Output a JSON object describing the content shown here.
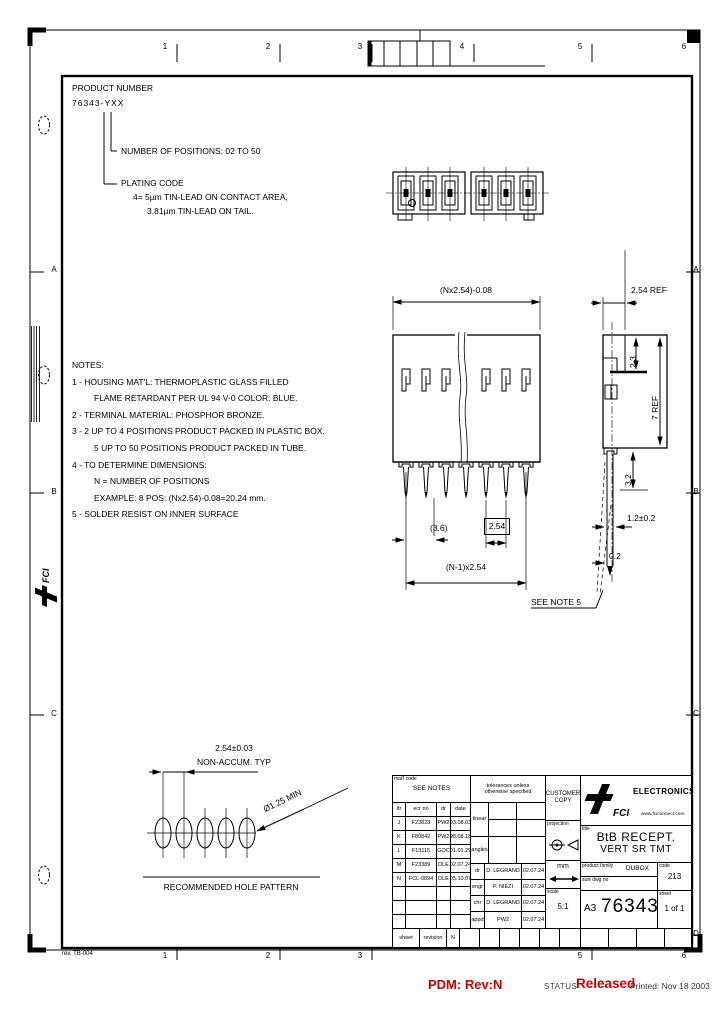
{
  "colors": {
    "line": "#000000",
    "paper": "#ffffff",
    "status_red": "#cc0000"
  },
  "icons": {
    "logo": "fci-lightning-f",
    "projection": "third-angle-projection",
    "units_arrow": "double-arrow"
  },
  "status_bar": {
    "pdm": "PDM: Rev:N",
    "status_label": "STATUS",
    "status_value": "Released",
    "printed": "Printed: Nov 18 2003"
  },
  "margins": {
    "rev_note": "rev. TB-004",
    "zone_numbers": [
      "1",
      "2",
      "3",
      "4",
      "5",
      "6"
    ],
    "zone_letters": [
      "A",
      "B",
      "C",
      "D"
    ]
  },
  "product": {
    "label": "PRODUCT NUMBER",
    "number": "76343-YXX",
    "positions": "NUMBER OF POSITIONS: 02 TO 50",
    "plating_title": "PLATING CODE",
    "plating1": "4= 5µm TIN-LEAD ON CONTACT AREA,",
    "plating2": "3.81µm TIN-LEAD ON TAIL."
  },
  "notes": {
    "lines": [
      "NOTES:",
      "1 - HOUSING MAT'L: THERMOPLASTIC GLASS FILLED",
      "FLAME RETARDANT PER UL 94 V-0 COLOR: BLUE.",
      "2 - TERMINAL MATERIAL: PHOSPHOR BRONZE.",
      "3 - 2 UP TO 4 POSITIONS PRODUCT PACKED IN PLASTIC BOX.",
      "5 UP TO 50 POSITIONS PRODUCT PACKED IN TUBE.",
      "4 - TO DETERMINE DIMENSIONS:",
      "N = NUMBER OF POSITIONS",
      "EXAMPLE: 8 POS: (Nx2.54)-0.08=20.24 mm.",
      "5 - SOLDER RESIST ON INNER SURFACE"
    ]
  },
  "dims": {
    "front_width": "(Nx2.54)-0.08",
    "pitch_ref": "2.54 REF",
    "pin_len": "(3.6)",
    "pitch_basic": "2.54",
    "span": "(N-1)x2.54",
    "body_h": "7 REF",
    "top_depth": "2.3",
    "tail_len": "3.2",
    "tail_w": "1.2±0.2",
    "resist": "0.2",
    "see_note": "SEE NOTE 5"
  },
  "hole_pattern": {
    "pitch": "2.54±0.03",
    "non_accum": "NON-ACCUM. TYP",
    "dia": "Ø1.25 MIN",
    "caption": "RECOMMENDED HOLE PATTERN"
  },
  "title_block": {
    "matl_label": "mat'l code",
    "matl_value": "SEE NOTES",
    "tol_note1": "tolerances unless",
    "tol_note2": "otherwise specified",
    "customer1": "CUSTOMER",
    "customer2": "COPY",
    "rev_headers": [
      "ltr",
      "ecr no",
      "dr",
      "date"
    ],
    "revisions": [
      {
        "ltr": "J",
        "ecr": "F23823",
        "dr": "PW2",
        "date": "93.08.03"
      },
      {
        "ltr": "K",
        "ecr": "F80842",
        "dr": "PW2",
        "date": "98.08.18"
      },
      {
        "ltr": "L",
        "ecr": "F13115",
        "dr": "GOC",
        "date": "01.01.29"
      },
      {
        "ltr": "M",
        "ecr": "F23389",
        "dr": "DLE",
        "date": "02.07.24"
      },
      {
        "ltr": "N",
        "ecr": "FCL-0894",
        "dr": "DLE",
        "date": "05.10.07"
      }
    ],
    "linear_label": "linear",
    "angles_label": "angles",
    "signoff": [
      {
        "role": "dr",
        "name": "D. LEGRAND",
        "date": "02.07.24"
      },
      {
        "role": "engr",
        "name": "P. NIEZI",
        "date": "02.07.24"
      },
      {
        "role": "chr",
        "name": "D. LEGRAND",
        "date": "02.07.24"
      },
      {
        "role": "appd",
        "name": "PW2",
        "date": "02.07.24"
      }
    ],
    "projection_label": "projection",
    "units": "mm",
    "scale_label": "scale",
    "scale_value": "5:1",
    "brand": {
      "logo": "FCI",
      "name": "ELECTRONICS",
      "site": "www.fciconnect.com"
    },
    "title_label": "title",
    "title1": "BtB RECEPT.",
    "title2": "VERT SR TMT",
    "family_label": "product family",
    "family_value": "DUBOX",
    "code_label": "code",
    "code_value": "213",
    "size_label": "size dwg no",
    "size_value": "A3",
    "dwg_no": "76343",
    "sheet_label": "sheet",
    "sheet_value": "1 of 1",
    "strip": {
      "sheet": "sheet",
      "revision": "revision",
      "rev_value": "N"
    }
  }
}
